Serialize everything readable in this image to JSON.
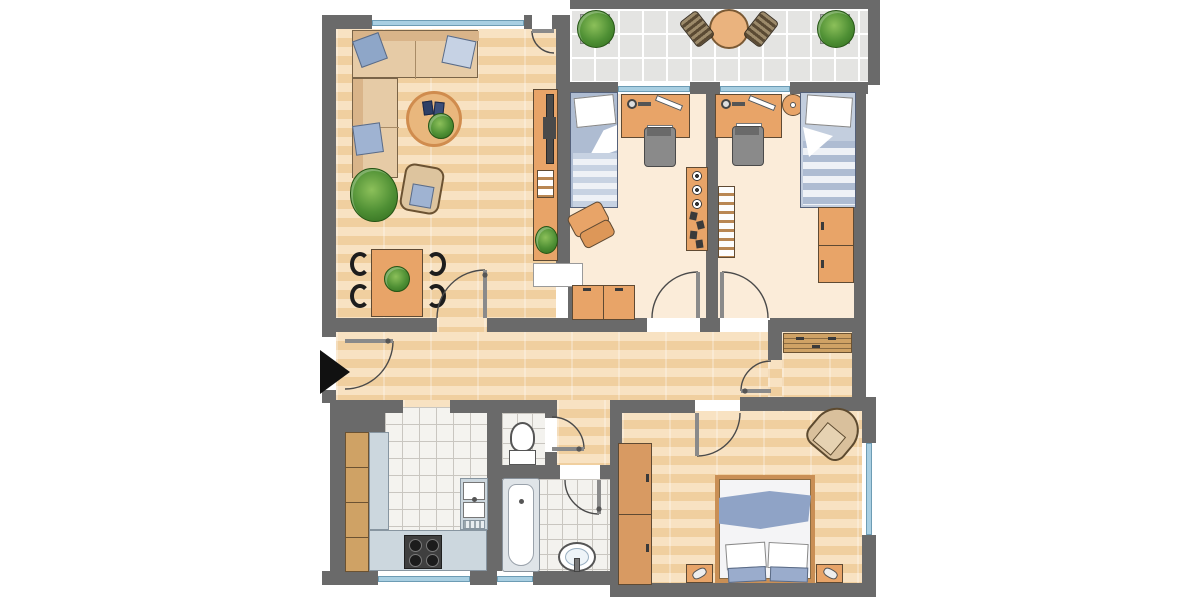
{
  "meta": {
    "title": "apartment-floor-plan",
    "kind": "architectural-floor-plan-top-view"
  },
  "palette": {
    "wall": "#6a6a6a",
    "parquet": "#f5d9ae",
    "room_cream": "#fbecd9",
    "tile": "#f4f3ef",
    "balcony_tile": "#e4e4e2",
    "furniture_wood": "#e8a468",
    "cabinet_wood": "#cfa265",
    "counter": "#ccd7de",
    "appliance_dark": "#3f3f3f",
    "bed_blue": "#aebcd2",
    "blanket_blue": "#8fa3c6",
    "pillow_white": "#ffffff",
    "plant_green": "#4e8f34",
    "rug": "#e9b77d",
    "window_glass": "#a9cfe2",
    "door_line": "#4a4a4a",
    "entrance_arrow": "#111111"
  },
  "rooms": {
    "living_room": {
      "id": "living-room",
      "floor": "parquet",
      "furniture": [
        "corner-sofa",
        "sofa-pillows-x3",
        "round-rug",
        "coffee-table-books",
        "coffee-table-plant",
        "potted-plant",
        "rattan-chair",
        "dining-table",
        "dining-table-plant",
        "dining-chairs-x4",
        "tv-sideboard",
        "tv",
        "sideboard-shelf",
        "sideboard-plant"
      ]
    },
    "balcony": {
      "id": "balcony",
      "floor": "tiles",
      "furniture": [
        "potted-plant-left",
        "potted-plant-right",
        "bistro-table",
        "balcony-chair-left",
        "balcony-chair-right"
      ]
    },
    "kids_room_1": {
      "id": "kids-bedroom-left",
      "floor": "cream",
      "furniture": [
        "single-bed",
        "desk",
        "desk-lamp",
        "ruler",
        "keyboard",
        "desk-chair",
        "wall-shelf-with-speakers",
        "toy-letter-blocks",
        "beanbag",
        "low-cabinets"
      ]
    },
    "kids_room_2": {
      "id": "kids-bedroom-right",
      "floor": "cream",
      "furniture": [
        "desk",
        "desk-lamp",
        "ruler",
        "keyboard",
        "desk-chair",
        "round-side-table",
        "single-bed",
        "wardrobe",
        "wall-shelf"
      ]
    },
    "hallway": {
      "id": "hallway",
      "floor": "parquet",
      "furniture": [
        "entrance-door",
        "entrance-arrow"
      ]
    },
    "alcove": {
      "id": "wardrobe-alcove",
      "floor": "parquet",
      "furniture": [
        "slatted-bench",
        "alcove-door"
      ]
    },
    "kitchen": {
      "id": "kitchen",
      "floor": "tiles",
      "furniture": [
        "tall-cabinets",
        "worktop-left",
        "worktop-bottom",
        "stove",
        "double-sink-with-drainboard"
      ]
    },
    "wc": {
      "id": "wc",
      "floor": "tiles",
      "furniture": [
        "toilet"
      ]
    },
    "bathroom": {
      "id": "bathroom",
      "floor": "tiles",
      "furniture": [
        "bathtub",
        "washbasin"
      ]
    },
    "master_bedroom": {
      "id": "bedroom",
      "floor": "parquet",
      "furniture": [
        "double-bed",
        "blue-blanket",
        "pillows-x2",
        "cushions-x2",
        "nightstand-left",
        "nightstand-right",
        "reading-lamps-x2",
        "wardrobe",
        "armchair"
      ]
    }
  },
  "doors": [
    "entrance",
    "living-to-hall",
    "living-to-balcony",
    "kids-left",
    "kids-right",
    "alcove",
    "bedroom",
    "wc",
    "bathroom"
  ],
  "windows": [
    "living-top",
    "kids-left-balcony-door",
    "kids-right-balcony-door",
    "kitchen-bottom",
    "bathroom-bottom",
    "bedroom-right"
  ]
}
